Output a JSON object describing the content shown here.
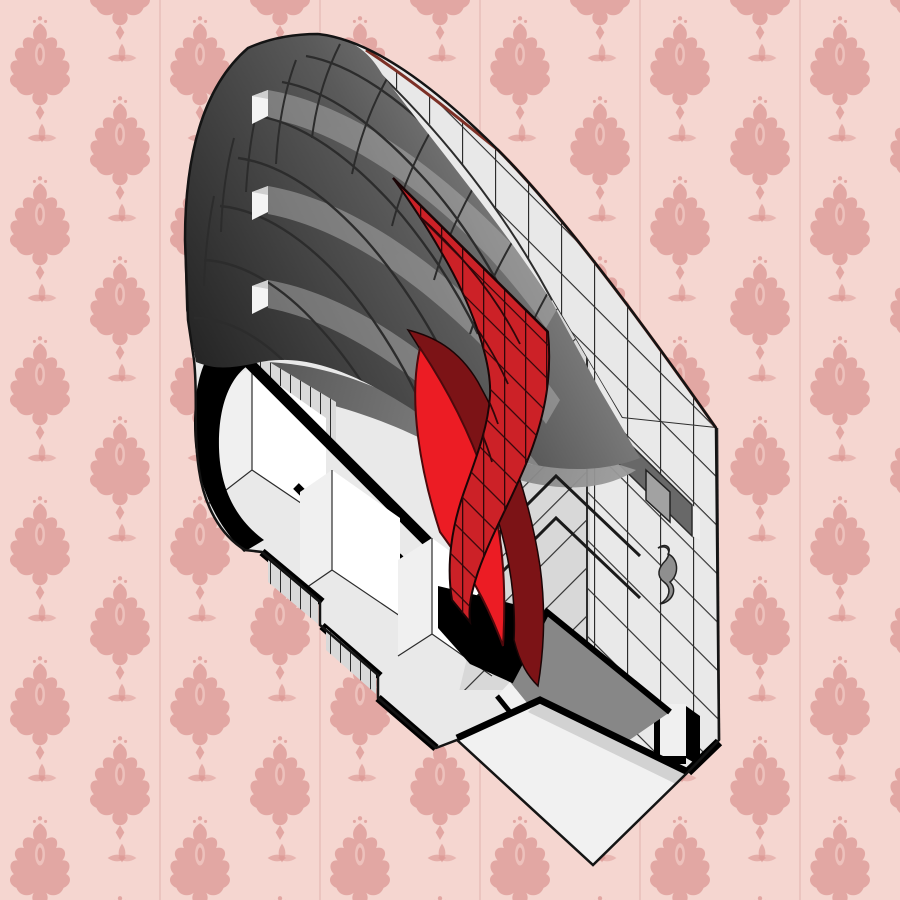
{
  "meta": {
    "description": "Axonometric cutaway illustration of a long building with a curved dark gridded roof, a light gray gridded end wall, a red highlighted curved roof panel, and a sectioned white interior with black cut walls, displayed over pink damask wallpaper",
    "style": "architectural axonometric diagram",
    "background": "pink damask wallpaper with vertical strip seams"
  },
  "illustration": {
    "building": "curved-roof hall, section cut at near end",
    "highlight_element": "red curved cladding panel with grid",
    "roof_window_slots": 3,
    "interior": "white rooms with black poché cut walls, stepped floor slabs, gray terrace plane"
  },
  "colors": {
    "pink_bg": "#f5d6d0",
    "pink_motif": "#dd9b97",
    "pink_seam": "#c98984",
    "outline": "#141414",
    "grid_line": "#2c2c2c",
    "roof_dark": "#262626",
    "roof_mid": "#5a5a5a",
    "roof_light": "#999999",
    "roof_band_light": "#b5b5b5",
    "slot_white": "#f4f4f4",
    "deck_light": "#e8e8e8",
    "deck_band": "#a6a6a6",
    "wall_light": "#e9e9e9",
    "wall_corner": "#d8d8d8",
    "ridge_red": "#7c3026",
    "parapet_dark": "#686868",
    "parapet_mid": "#8d8d8d",
    "window_gray": "#a2a2a2",
    "squiggle_gray": "#8f8f8f",
    "red_main": "#cc2127",
    "red_bright": "#ec1c24",
    "red_dark": "#a11b1f",
    "red_deep": "#7c1316",
    "red_grid": "#30070a",
    "poche_black": "#000000",
    "interior_white": "#ffffff",
    "interior_light": "#f0f0f0",
    "interior_shadow": "#c4c4c4",
    "mullion_bg": "#d9d9d9",
    "floor_gray": "#878787",
    "slab_white": "#f1f1f1",
    "slab_shadow": "#d2d2d2",
    "soffit_dark": "#4f4f4f",
    "soffit_light": "#9a9a9a"
  }
}
